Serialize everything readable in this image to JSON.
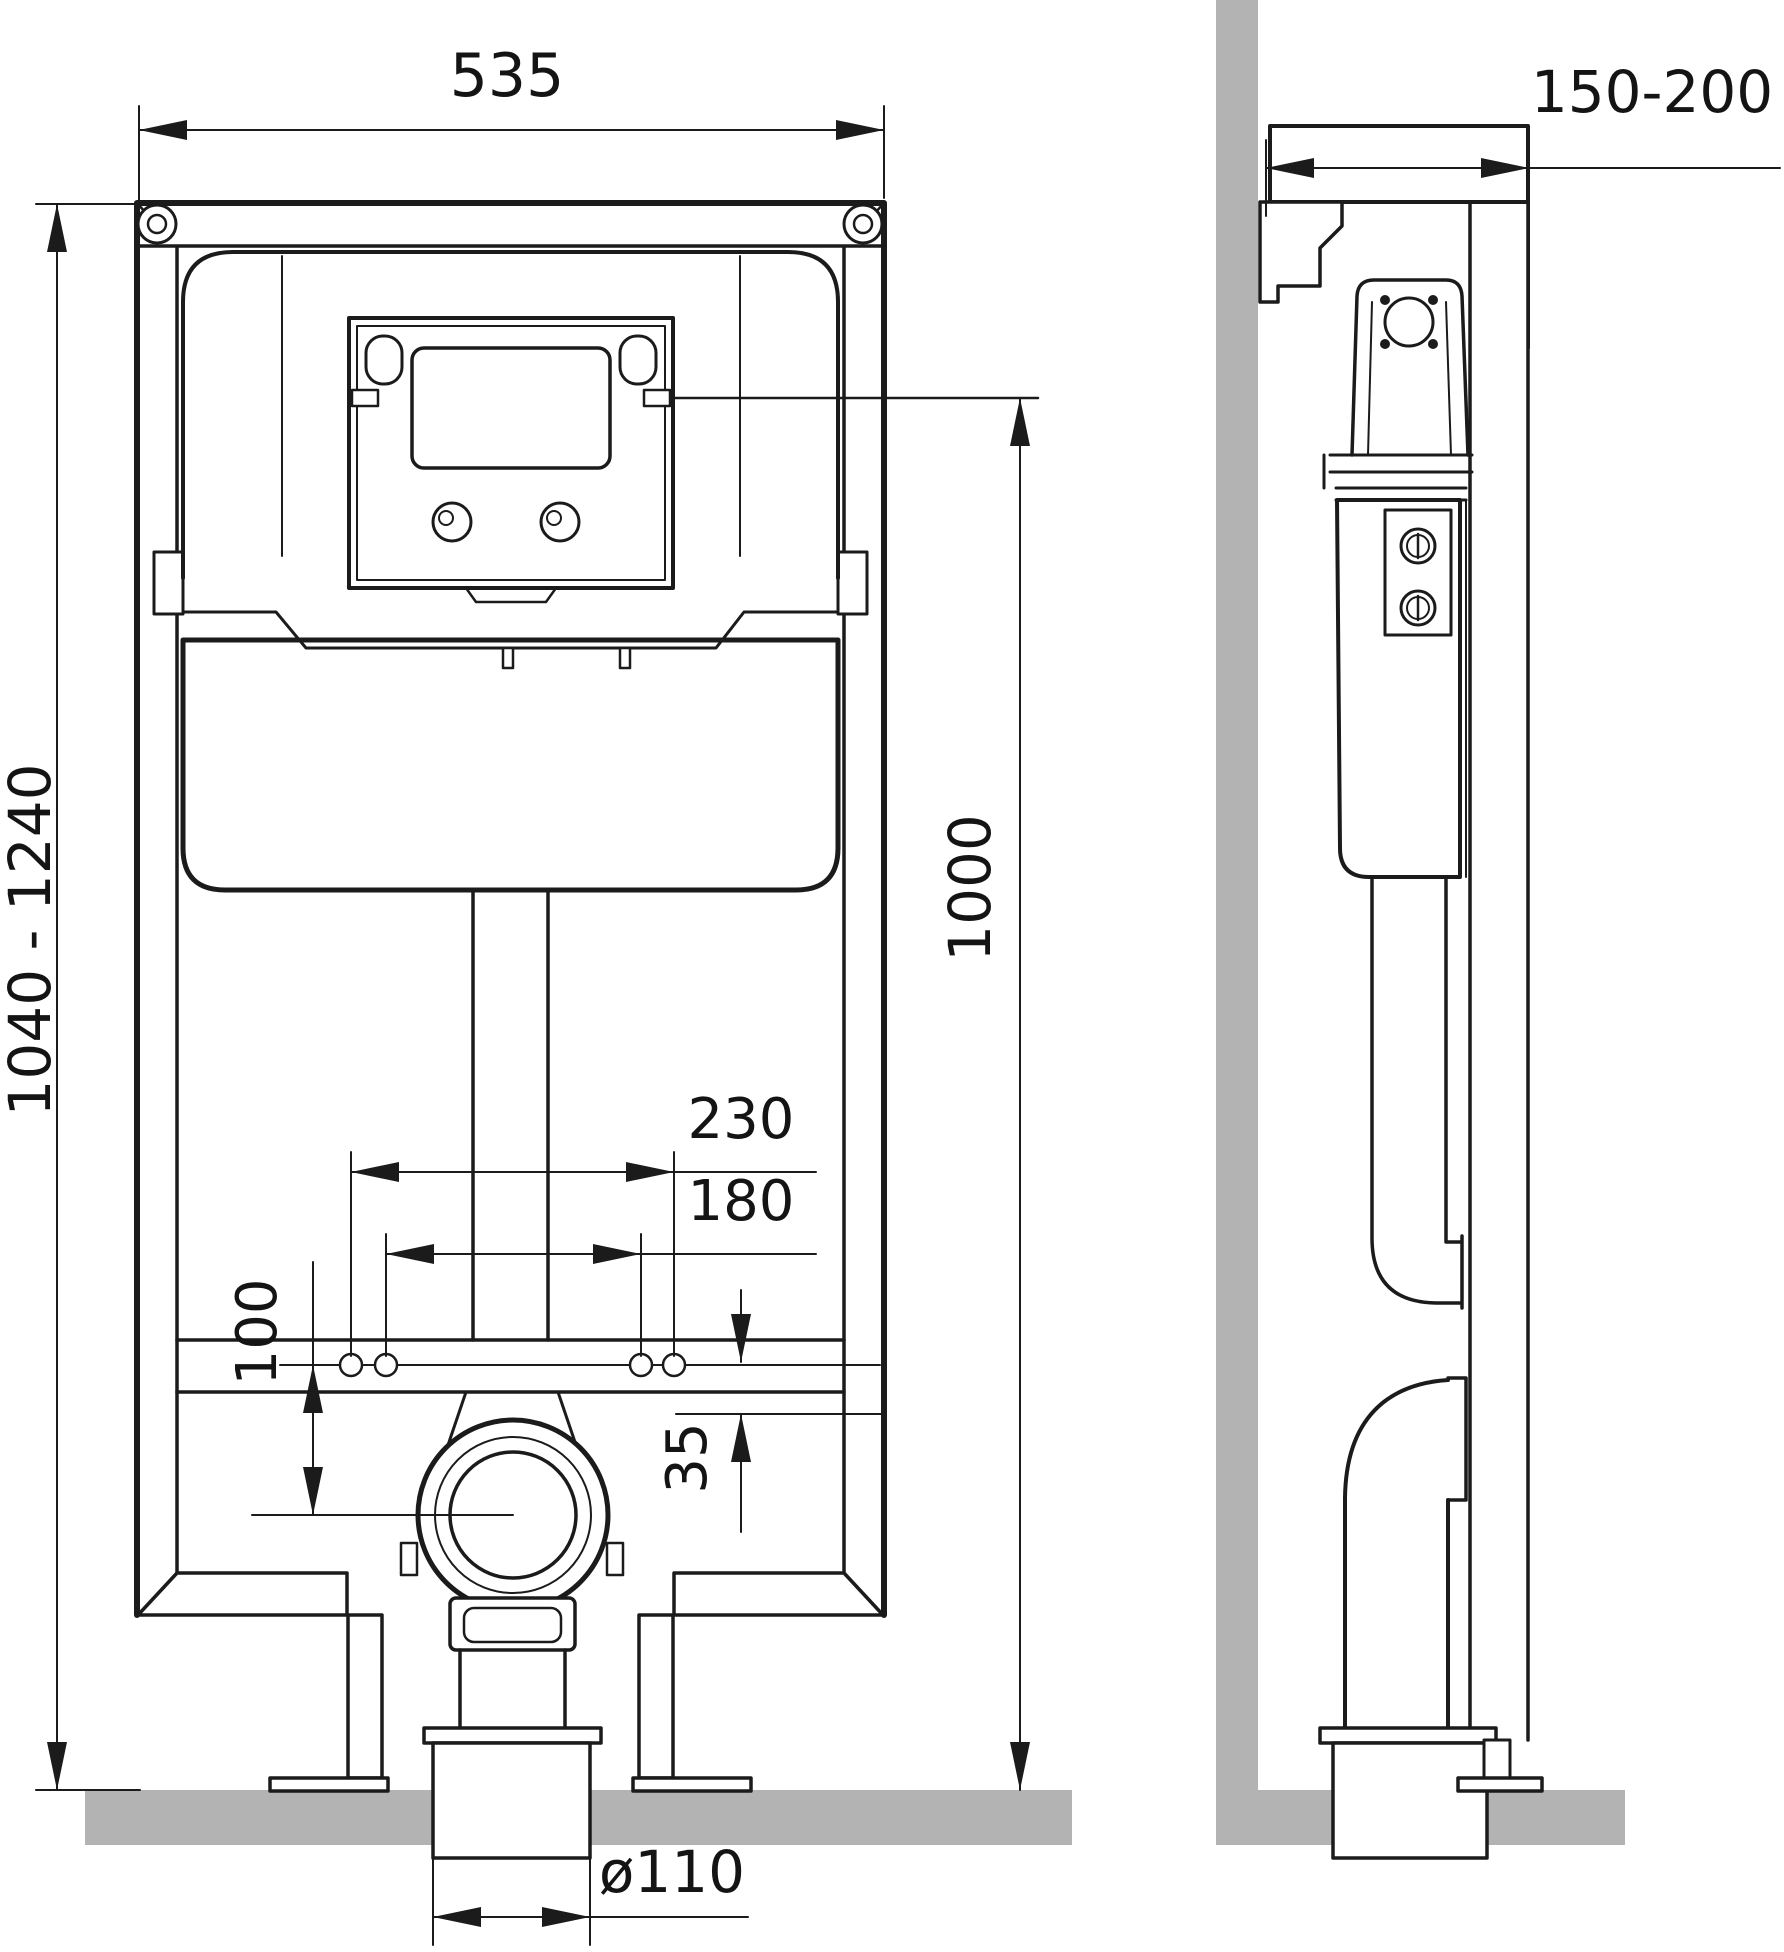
{
  "drawing": {
    "labels": {
      "frame_width": "535",
      "frame_height_range": "1040 - 1240",
      "flush_plate_height": "1000",
      "fixing_bolts_outer": "230",
      "fixing_bolts_inner": "180",
      "drain_center_drop": "100",
      "rail_offset": "35",
      "drain_pipe_diameter": "ø110",
      "frame_depth_range": "150-200"
    },
    "colors": {
      "line": "#1b1b1b",
      "masonry": "#b3b3b3",
      "background": "#ffffff"
    }
  }
}
